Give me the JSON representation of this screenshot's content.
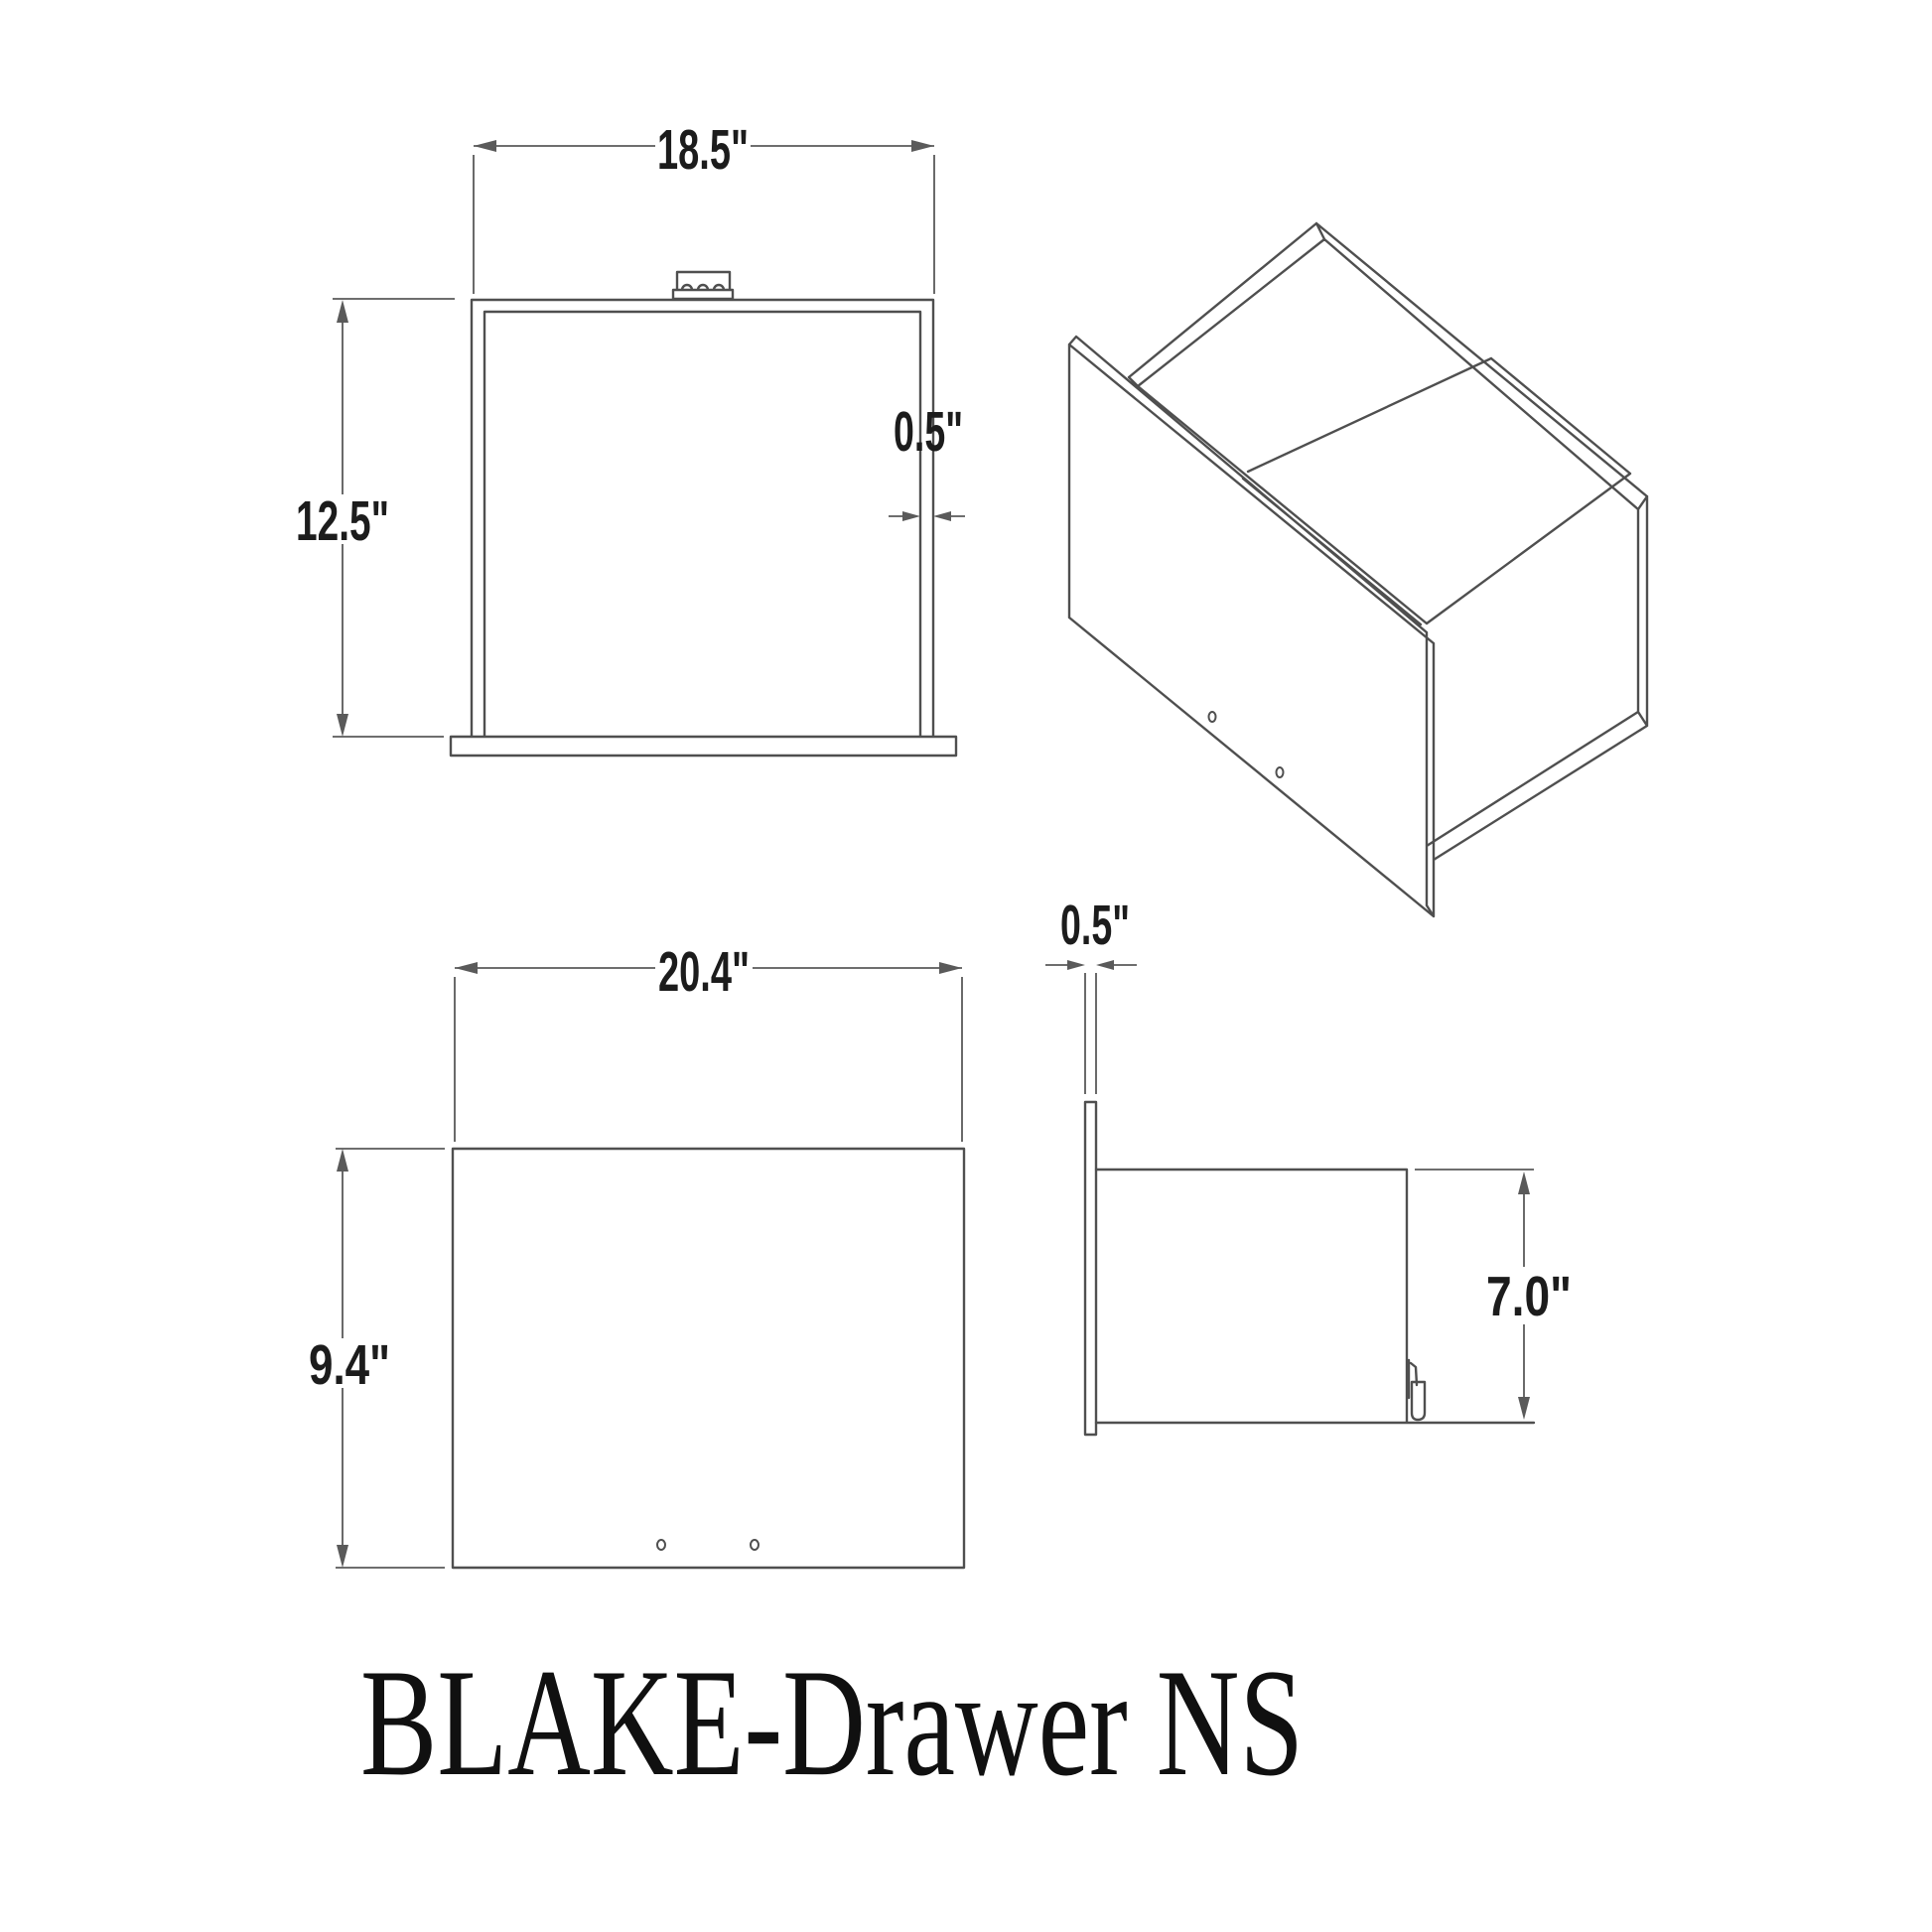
{
  "drawing": {
    "title": "BLAKE-Drawer NS",
    "front_view": {
      "width": "18.5\"",
      "height": "12.5\"",
      "thickness": "0.5\""
    },
    "front_panel_view": {
      "width": "20.4\"",
      "height": "9.4\""
    },
    "side_view": {
      "thickness": "0.5\"",
      "height": "7.0\""
    },
    "colors": {
      "line": "#4f4f4f",
      "dim_line": "#5a5a5a",
      "text": "#1c1c1c"
    }
  }
}
